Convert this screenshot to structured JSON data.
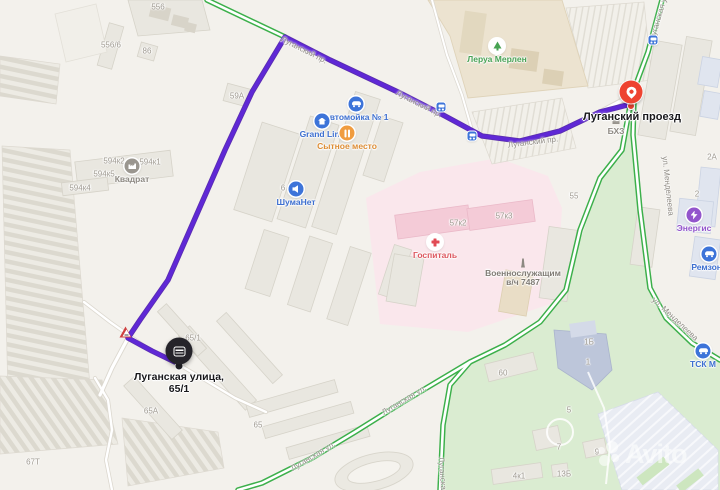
{
  "map": {
    "markers": {
      "point": {
        "label": "Луганский проезд"
      },
      "destination": {
        "line1": "Луганская улица,",
        "line2": "65/1"
      }
    },
    "watermark": {
      "text": "Avito"
    },
    "colors": {
      "route": "#5f28d6",
      "road_free_flow_green": "#3bb04a",
      "poi_blue": "#3d74d9",
      "poi_orange": "#f09c3f",
      "poi_green": "#4aa356",
      "poi_red": "#dd5860",
      "poi_purple": "#9355cc",
      "marker_red": "#ee4330",
      "marker_black": "#25242a"
    },
    "street_labels": [
      {
        "t": "Луганский пр.",
        "x": 304,
        "y": 50,
        "r": 27
      },
      {
        "t": "Луганский пр.",
        "x": 419,
        "y": 104,
        "r": 27
      },
      {
        "t": "Луганский пр.",
        "x": 533,
        "y": 142,
        "r": -7
      },
      {
        "t": "Луганская ул.",
        "x": 659,
        "y": 16,
        "r": -74
      },
      {
        "t": "Луганская ул.",
        "x": 404,
        "y": 400,
        "r": -31
      },
      {
        "t": "Луганская ул.",
        "x": 313,
        "y": 456,
        "r": -31
      },
      {
        "t": "Луганская ул.",
        "x": 443,
        "y": 482,
        "r": 86
      },
      {
        "t": "ул. Менделеева",
        "x": 668,
        "y": 186,
        "r": 84
      },
      {
        "t": "ул. Менделеева",
        "x": 675,
        "y": 319,
        "r": 43
      }
    ],
    "building_labels": [
      {
        "t": "556",
        "x": 158,
        "y": 7
      },
      {
        "t": "556/6",
        "x": 111,
        "y": 45
      },
      {
        "t": "86",
        "x": 147,
        "y": 51
      },
      {
        "t": "59А",
        "x": 237,
        "y": 96
      },
      {
        "t": "594к2",
        "x": 114,
        "y": 161
      },
      {
        "t": "594к1",
        "x": 150,
        "y": 162
      },
      {
        "t": "594к5",
        "x": 104,
        "y": 174
      },
      {
        "t": "594к4",
        "x": 80,
        "y": 188
      },
      {
        "t": "6",
        "x": 283,
        "y": 188
      },
      {
        "t": "57к2",
        "x": 458,
        "y": 223
      },
      {
        "t": "57к3",
        "x": 504,
        "y": 216
      },
      {
        "t": "55",
        "x": 574,
        "y": 196
      },
      {
        "t": "2А",
        "x": 712,
        "y": 157
      },
      {
        "t": "2",
        "x": 697,
        "y": 194
      },
      {
        "t": "65/1",
        "x": 193,
        "y": 338
      },
      {
        "t": "65А",
        "x": 151,
        "y": 411
      },
      {
        "t": "65",
        "x": 258,
        "y": 425
      },
      {
        "t": "67Т",
        "x": 33,
        "y": 462
      },
      {
        "t": "60",
        "x": 503,
        "y": 373
      },
      {
        "t": "5",
        "x": 569,
        "y": 410
      },
      {
        "t": "7",
        "x": 559,
        "y": 447
      },
      {
        "t": "9",
        "x": 597,
        "y": 452
      },
      {
        "t": "4к1",
        "x": 519,
        "y": 476
      },
      {
        "t": "13Б",
        "x": 564,
        "y": 474
      },
      {
        "t": "1Б",
        "x": 589,
        "y": 342
      },
      {
        "t": "1",
        "x": 588,
        "y": 362
      }
    ],
    "pois": [
      {
        "id": "kvadrat",
        "label": "Квадрат",
        "icon": "factory",
        "x": 132,
        "y": 166,
        "bg": "#9a968f",
        "color": "#8d8982"
      },
      {
        "id": "shumanet",
        "label": "ШумаНет",
        "icon": "sound",
        "x": 296,
        "y": 189,
        "bg": "#3d74d9",
        "color": "#3d6fd0"
      },
      {
        "id": "carwash",
        "label": "Автомойка № 1",
        "icon": "car",
        "x": 356,
        "y": 104,
        "bg": "#3d74d9",
        "color": "#3d6fd0"
      },
      {
        "id": "grandline",
        "label": "Grand Line",
        "icon": "house",
        "x": 322,
        "y": 121,
        "bg": "#3d74d9",
        "color": "#3d6fd0"
      },
      {
        "id": "sytnoe",
        "label": "Сытное место",
        "icon": "food",
        "x": 347,
        "y": 133,
        "bg": "#f09c3f",
        "color": "#dd8d35"
      },
      {
        "id": "leroy",
        "label": "Леруа Мерлен",
        "icon": "tree",
        "x": 497,
        "y": 46,
        "bg": "#ffffff",
        "color": "#4aa356"
      },
      {
        "id": "gospital",
        "label": "Госпиталь",
        "icon": "cross",
        "x": 435,
        "y": 242,
        "bg": "#ffffff",
        "color": "#dd5860"
      },
      {
        "id": "memorial",
        "label": "Военнослужащим",
        "label2": "в/ч 7487",
        "icon": "monument",
        "x": 523,
        "y": 263,
        "plain": true,
        "color": "#807c75"
      },
      {
        "id": "bhz",
        "label": "БХЗ",
        "icon": "factory-grey",
        "x": 616,
        "y": 121,
        "plain": true,
        "color": "#8d8982"
      },
      {
        "id": "energis",
        "label": "Энергис",
        "icon": "bolt",
        "x": 694,
        "y": 215,
        "bg": "#9355cc",
        "color": "#9355cc"
      },
      {
        "id": "remzona",
        "label": "Ремзона",
        "icon": "car",
        "x": 709,
        "y": 254,
        "bg": "#3d74d9",
        "color": "#3d6fd0"
      },
      {
        "id": "tsk",
        "label": "ТСК М",
        "icon": "car",
        "x": 703,
        "y": 351,
        "bg": "#3d74d9",
        "color": "#3d6fd0"
      }
    ],
    "bus_stops": [
      {
        "x": 441,
        "y": 107
      },
      {
        "x": 472,
        "y": 136
      },
      {
        "x": 653,
        "y": 40
      }
    ]
  }
}
